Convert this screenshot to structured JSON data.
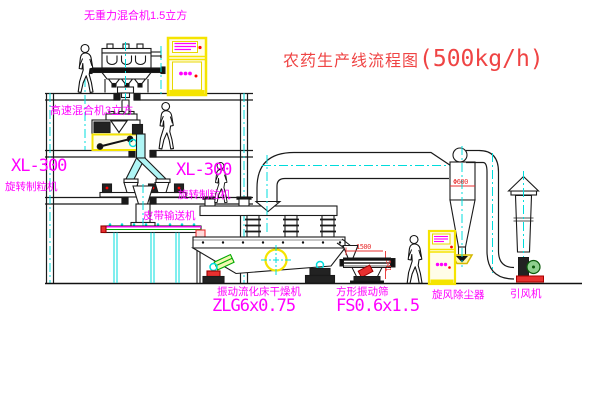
{
  "title": {
    "text_zh": "农药生产线流程图",
    "capacity": "(500kg/h)"
  },
  "equipment_labels": {
    "zero_gravity_mixer": "无重力混合机1.5立方",
    "high_speed_mixer": "高速混合机3立方",
    "granulator_left": {
      "model": "XL-300",
      "name": "旋转制粒机"
    },
    "granulator_center": {
      "model": "XL-300",
      "name": "旋转制粒机"
    },
    "belt_conveyor": "皮带输送机",
    "fluid_bed_dryer": {
      "name": "振动流化床干燥机",
      "model": "ZLG6x0.75"
    },
    "square_vibrating_sieve": {
      "name": "方形振动筛",
      "model": "FS0.6x1.5"
    },
    "cyclone_dust_collector": "旋风除尘器",
    "induced_draft_fan": "引风机"
  },
  "dimension_annotations": {
    "cyclone_diameter": "Φ600",
    "sieve_length": "1500",
    "sieve_height": "541"
  },
  "colors": {
    "label_magenta": "#ff00ff",
    "title_red": "#ef4444",
    "dimension_red": "#e83030",
    "centerline_cyan": "#00dcdc",
    "highlight_yellow": "#f5e400",
    "line_black": "#1a1a1a"
  }
}
